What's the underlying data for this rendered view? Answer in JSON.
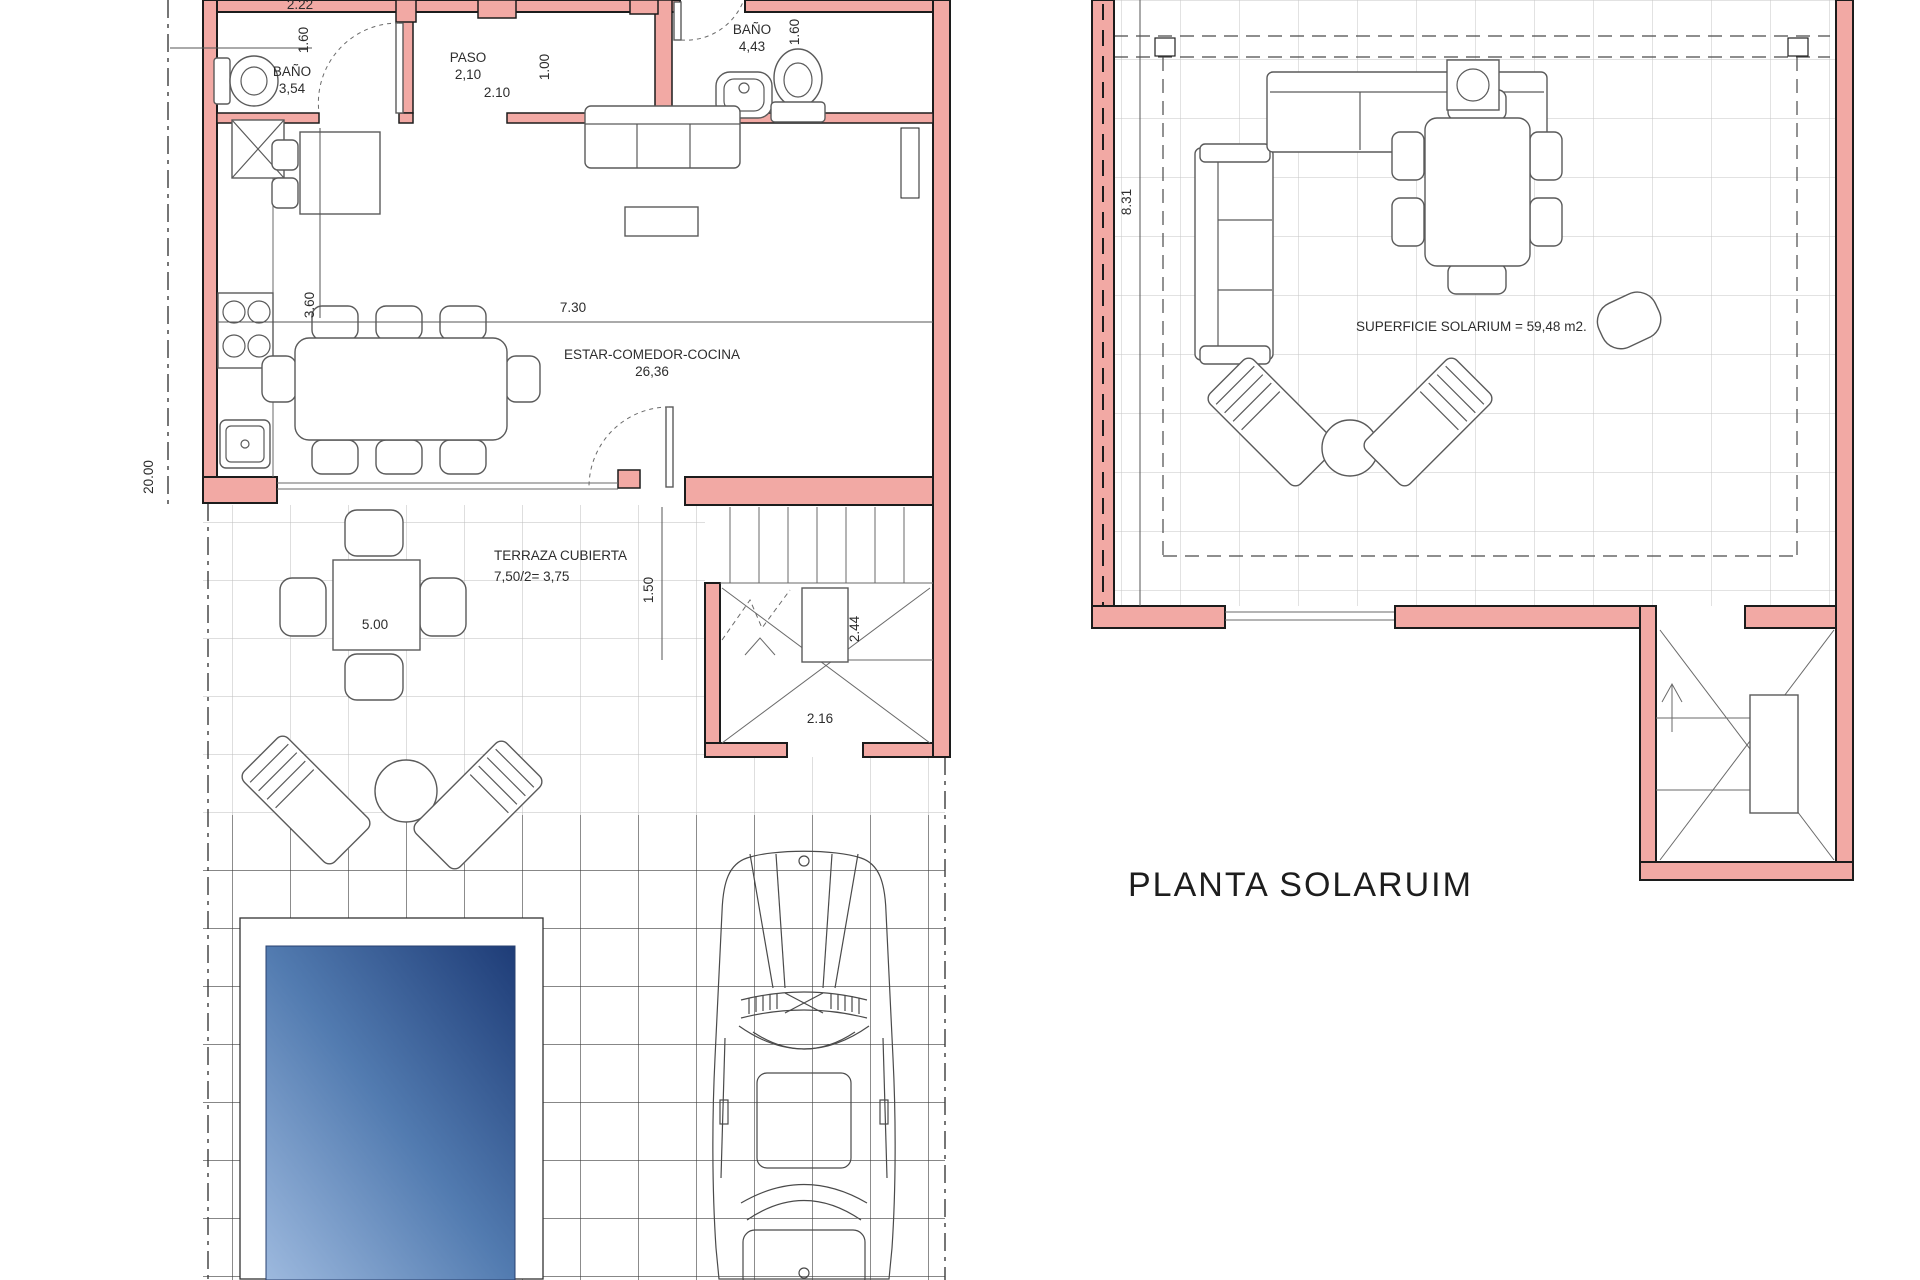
{
  "ground_floor": {
    "bano1": {
      "label": "BAÑO",
      "area": "3,54"
    },
    "paso": {
      "label": "PASO",
      "area": "2,10"
    },
    "bano2": {
      "label": "BAÑO",
      "area": "4,43"
    },
    "estar": {
      "label": "ESTAR-COMEDOR-COCINA",
      "area": "26,36"
    },
    "terraza": {
      "label": "TERRAZA CUBIERTA",
      "area": "7,50/2= 3,75"
    },
    "dims": {
      "top_width": "2.22",
      "bano1_depth": "1.60",
      "paso_clear": "1.00",
      "paso_width": "2.10",
      "bano2_depth": "1.60",
      "kitchen_depth": "3.60",
      "living_width": "7.30",
      "plot_depth": "20.00",
      "terrace_table": "5.00",
      "terrace_clear": "1.50",
      "stair_depth": "2.44",
      "stair_width": "2.16"
    }
  },
  "solarium": {
    "title": "PLANTA SOLARUIM",
    "surface_label": "SUPERFICIE SOLARIUM = 59,48 m2.",
    "dims": {
      "depth": "8.31"
    }
  },
  "colors": {
    "wall": "#f2a9a4",
    "pool_light": "#9db9de",
    "pool_dark": "#1e3c77"
  }
}
